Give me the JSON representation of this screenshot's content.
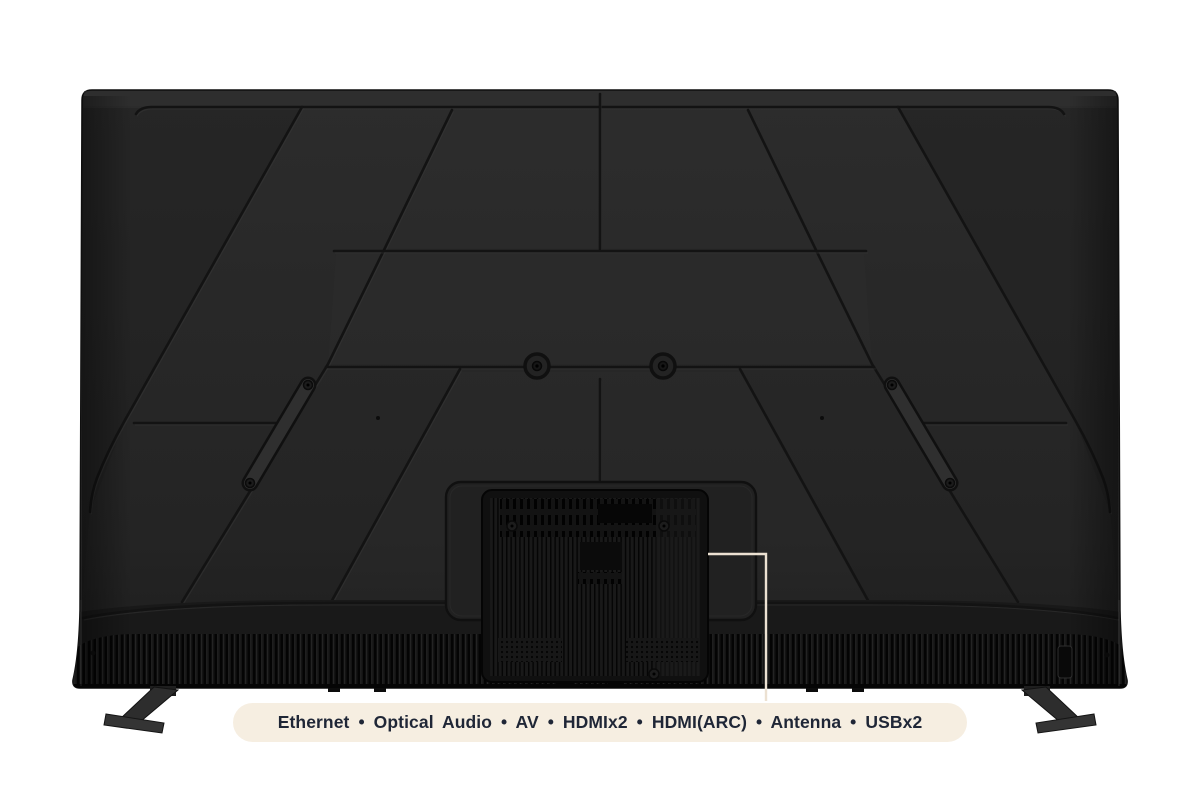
{
  "image": {
    "type": "product-rear-view",
    "subject": "TV rear panel with ports callout",
    "background_color": "#ffffff"
  },
  "tv": {
    "body_color": "#272727",
    "groove_color": "#141414",
    "speaker_grille_color": "#0d0d0d",
    "vesa_screw_count": 2,
    "stand_feet_count": 2
  },
  "callout": {
    "line_color": "#ece1d2",
    "pill_bg": "#f6eee1",
    "text_color": "#1f2636",
    "separator": "•",
    "ports": [
      "Ethernet",
      "Optical Audio",
      "AV",
      "HDMIx2",
      "HDMI(ARC)",
      "Antenna",
      "USBx2"
    ],
    "label": "Ethernet  •  Optical Audio  •  AV  •  HDMIx2  •  HDMI(ARC)  •  Antenna  •  USBx2"
  }
}
